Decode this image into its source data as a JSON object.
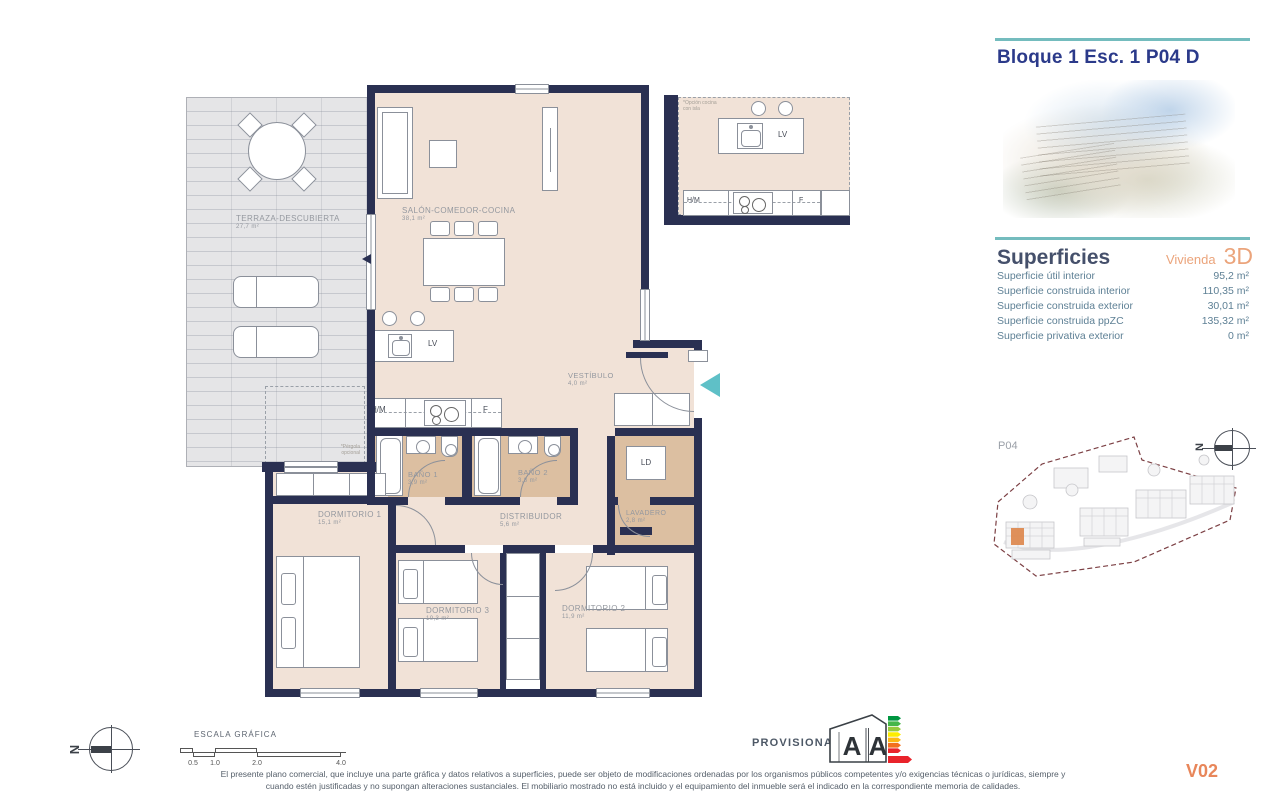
{
  "title": "Bloque 1 Esc. 1 P04 D",
  "superficies": {
    "heading": "Superficies",
    "unit_label": "Vivienda",
    "unit_value": "3D",
    "rows": [
      {
        "label": "Superficie útil interior",
        "value": "95,2 m²"
      },
      {
        "label": "Superficie construida interior",
        "value": "110,35 m²"
      },
      {
        "label": "Superficie construida exterior",
        "value": "30,01 m²"
      },
      {
        "label": "Superficie construida ppZC",
        "value": "135,32 m²"
      },
      {
        "label": "Superficie privativa exterior",
        "value": "0 m²"
      }
    ]
  },
  "floorplan": {
    "rooms": {
      "terraza": {
        "name": "TERRAZA-DESCUBIERTA",
        "area": "27,7 m²"
      },
      "salon": {
        "name": "SALÓN-COMEDOR-COCINA",
        "area": "38,1 m²"
      },
      "vestibulo": {
        "name": "VESTÍBULO",
        "area": "4,0 m²"
      },
      "bano1": {
        "name": "BAÑO 1",
        "area": "3,9 m²"
      },
      "bano2": {
        "name": "BAÑO 2",
        "area": "3,8 m²"
      },
      "dormitorio1": {
        "name": "DORMITORIO 1",
        "area": "15,1 m²"
      },
      "distribuidor": {
        "name": "DISTRIBUIDOR",
        "area": "5,6 m²"
      },
      "lavadero": {
        "name": "LAVADERO",
        "area": "2,8 m²"
      },
      "dormitorio3": {
        "name": "DORMITORIO 3",
        "area": "10,3 m²"
      },
      "dormitorio2": {
        "name": "DORMITORIO 2",
        "area": "11,9 m²"
      }
    },
    "appliances": {
      "dishwasher": "LV",
      "oven_micro": "H/M",
      "fridge": "F",
      "laundry": "LD"
    },
    "kitchen_note_1": "*Opción cocina",
    "kitchen_note_2": "con isla",
    "pergola_note_1": "*Pérgola",
    "pergola_note_2": "opcional"
  },
  "siteplan": {
    "floor_label": "P04",
    "compass_letter": "N"
  },
  "scalebar": {
    "label": "ESCALA GRÁFICA",
    "ticks": [
      "0.5",
      "1.0",
      "2.0",
      "4.0"
    ],
    "compass_letter": "N"
  },
  "energy": {
    "status": "PROVISIONAL",
    "consumption_letter": "A",
    "emissions_letter": "A"
  },
  "footer": {
    "disclaimer_line1": "El presente plano comercial, que incluye una parte gráfica y datos relativos a superficies, puede ser objeto de modificaciones ordenadas por los organismos públicos competentes y/o exigencias técnicas o jurídicas, siempre y",
    "disclaimer_line2": "cuando estén justificadas y no supongan alteraciones sustanciales. El mobiliario mostrado no está incluido y el equipamiento del inmueble será el indicado en la correspondiente memoria de calidades.",
    "version": "V02"
  },
  "colors": {
    "wall": "#2a3052",
    "room": "#f1e2d7",
    "wet": "#dcbfa1",
    "terrace": "#e5e5e7",
    "teal": "#74bcbe",
    "orange": "#eba47b",
    "title_blue": "#2b3a8a",
    "table_text": "#5e8095",
    "boundary": "#7c4044",
    "entry_arrow": "#5fc0c7"
  }
}
